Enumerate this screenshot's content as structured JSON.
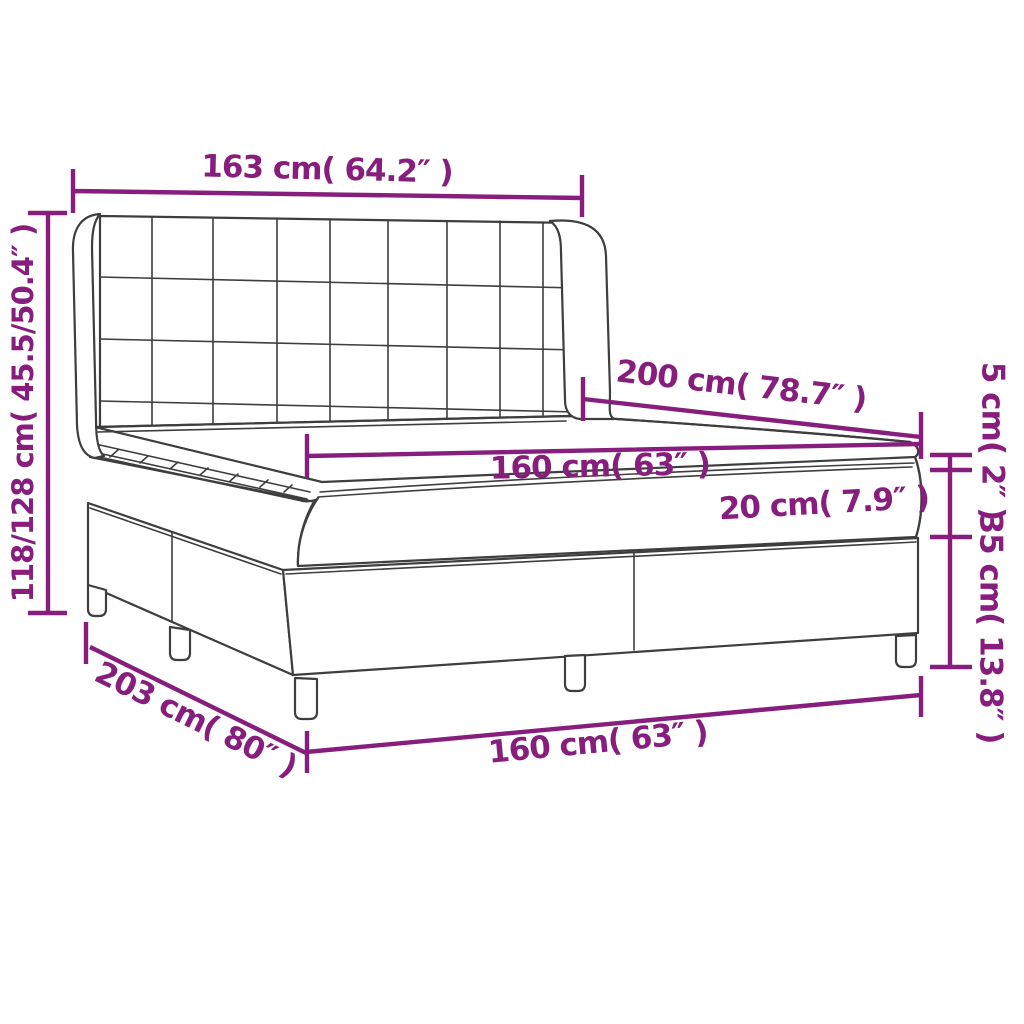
{
  "page": {
    "accent_color": "#871e7d",
    "line_color": "#3e3e3e",
    "background_color": "#ffffff"
  },
  "dimensions": {
    "headboard_width": "163 cm( 64.2″ )",
    "overall_height": "118/128 cm( 45.5/50.4″ )",
    "mattress_length": "200 cm( 78.7″ )",
    "mattress_width": "160 cm( 63″ )",
    "mattress_height": "20 cm( 7.9″ )",
    "topper_height": "5 cm( 2″ )",
    "base_height": "35 cm( 13.8″ )",
    "overall_length": "203 cm( 80″ )",
    "base_width": "160 cm( 63″ )"
  }
}
